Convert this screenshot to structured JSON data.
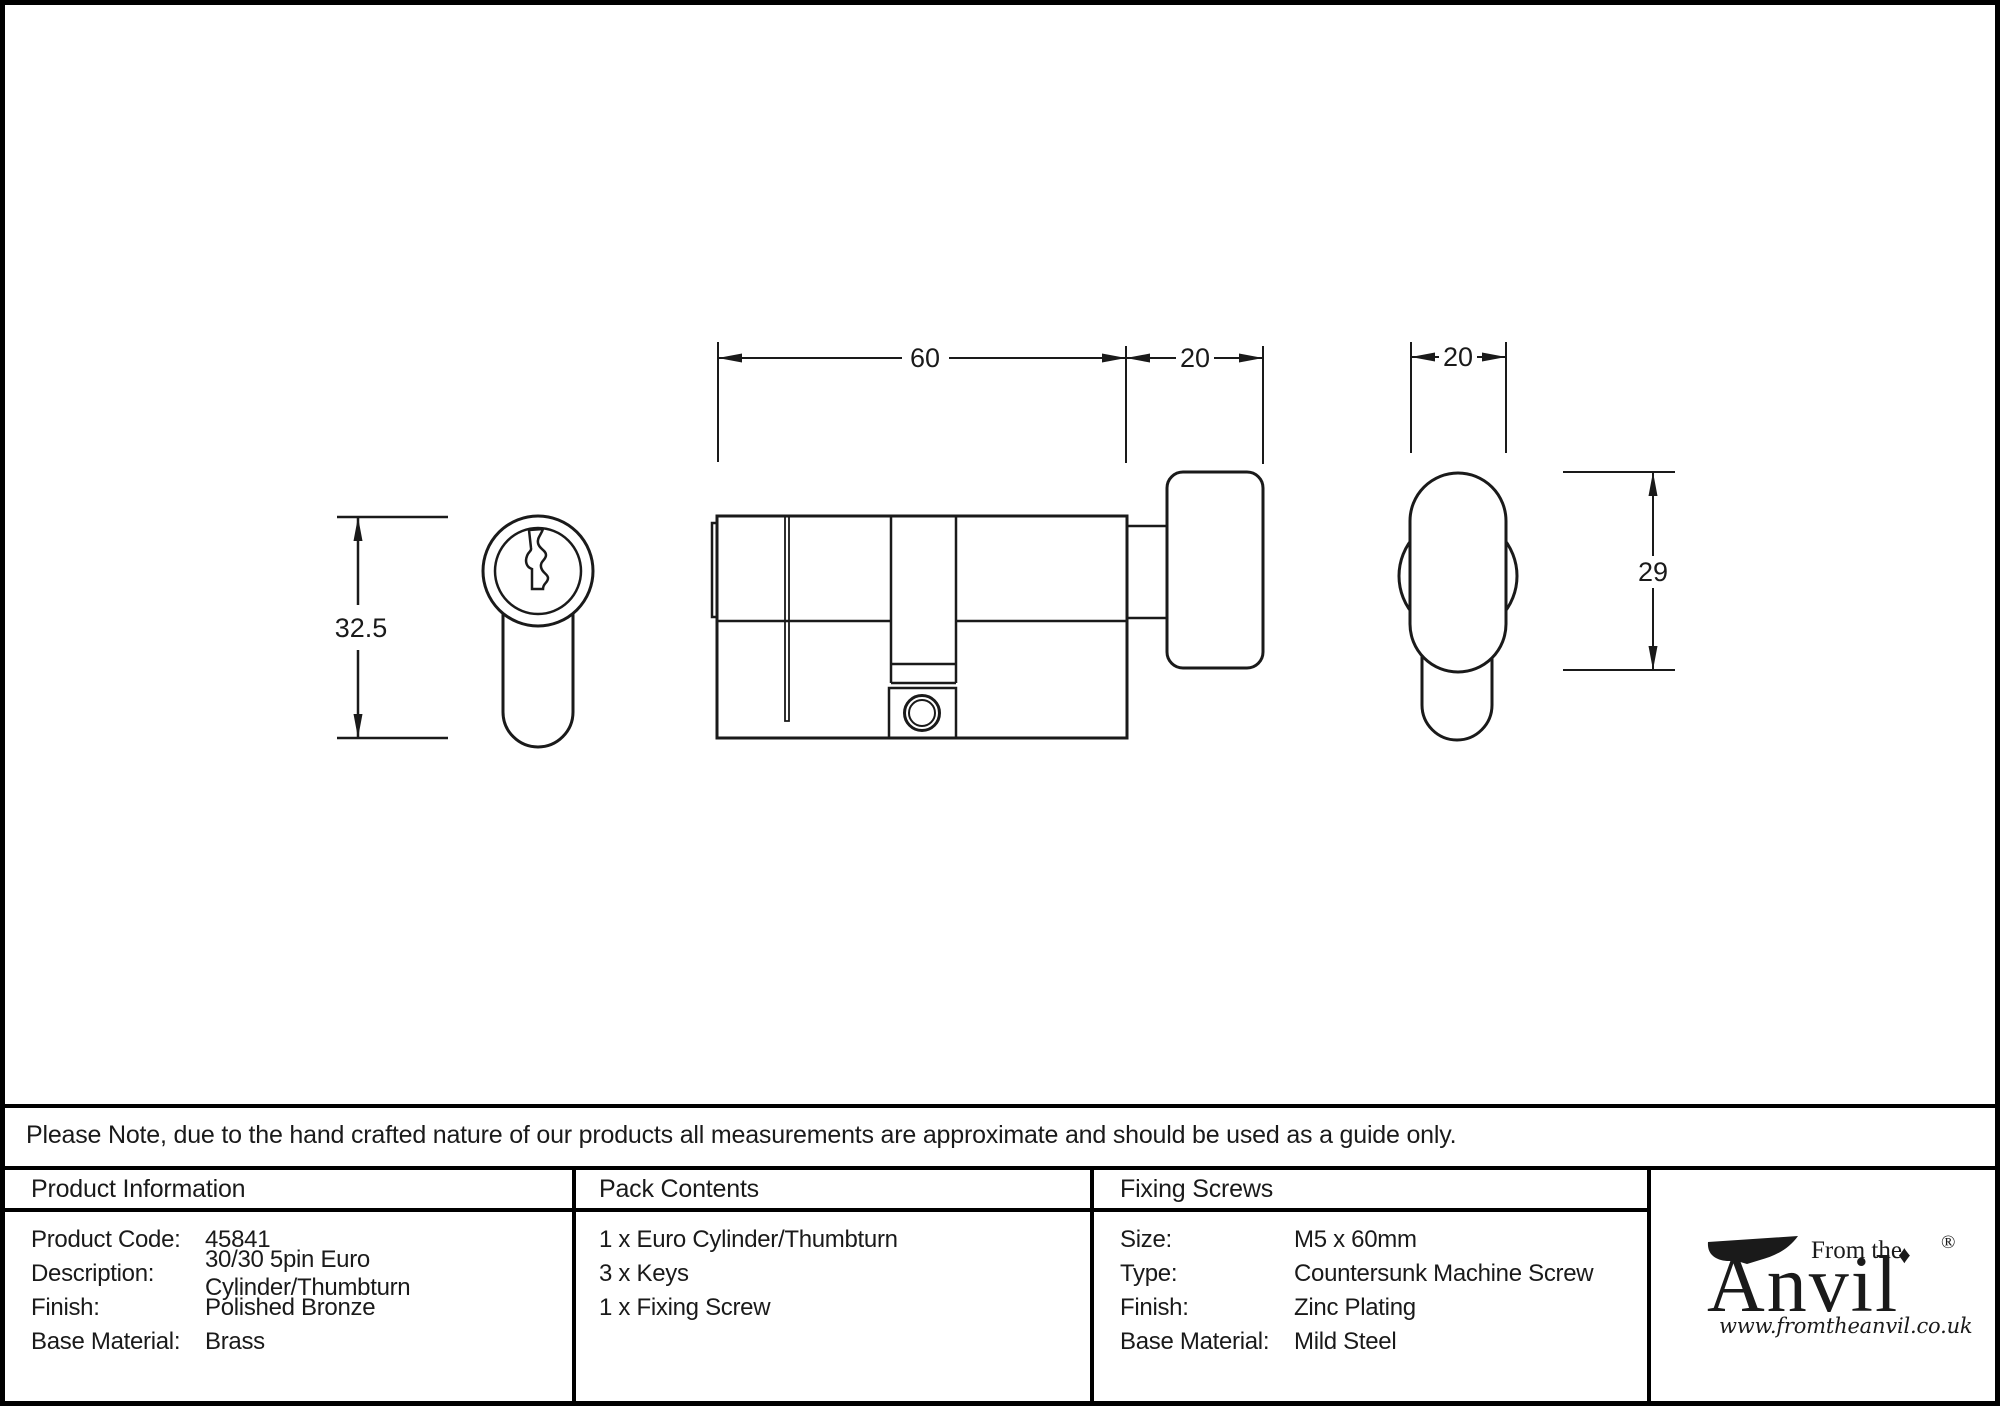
{
  "page": {
    "note": "Please Note, due to the hand crafted nature of our products all measurements are approximate and should be used as a guide only."
  },
  "drawing": {
    "dims": {
      "front_height": "32.5",
      "body_length": "60",
      "knob_depth": "20",
      "knob_width": "20",
      "knob_height": "29"
    }
  },
  "table": {
    "product_information": {
      "header": "Product Information",
      "rows": [
        {
          "label": "Product Code:",
          "value": "45841"
        },
        {
          "label": "Description:",
          "value": "30/30 5pin Euro Cylinder/Thumbturn"
        },
        {
          "label": "Finish:",
          "value": "Polished Bronze"
        },
        {
          "label": "Base Material:",
          "value": "Brass"
        }
      ]
    },
    "pack_contents": {
      "header": "Pack Contents",
      "items": [
        "1 x Euro Cylinder/Thumbturn",
        "3 x Keys",
        "1 x Fixing Screw"
      ]
    },
    "fixing_screws": {
      "header": "Fixing Screws",
      "rows": [
        {
          "label": "Size:",
          "value": "M5 x 60mm"
        },
        {
          "label": "Type:",
          "value": "Countersunk Machine Screw"
        },
        {
          "label": "Finish:",
          "value": "Zinc Plating"
        },
        {
          "label": "Base Material:",
          "value": "Mild Steel"
        }
      ]
    },
    "brand": {
      "tagline": "From the",
      "name": "Anvil",
      "diamond": "♦",
      "registered": "®",
      "website": "www.fromtheanvil.co.uk"
    }
  },
  "colors": {
    "ink": "#1a1a1a",
    "line": "#000000",
    "background": "#ffffff"
  }
}
